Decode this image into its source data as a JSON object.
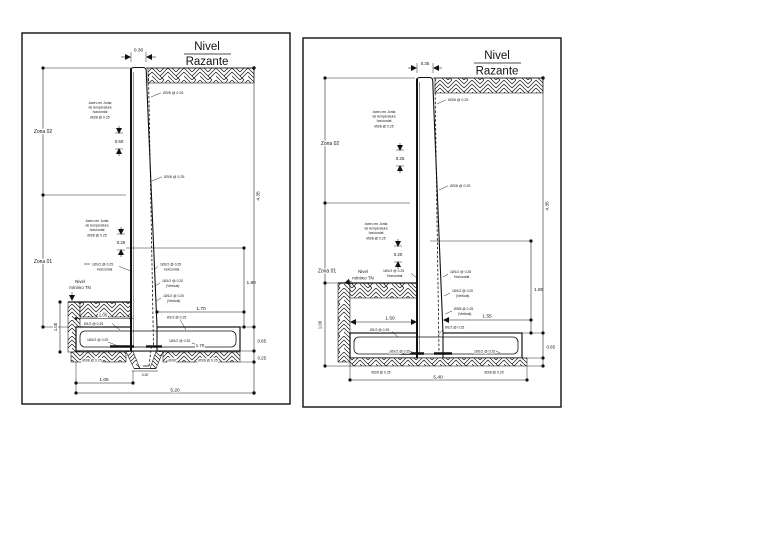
{
  "page": {
    "background": "#ffffff",
    "ink": "#111111"
  },
  "left_panel": {
    "title_top": "Nivel",
    "title_bottom": "Razante",
    "zona_02": "Zona 02",
    "zona_01": "Zona 01",
    "nivel_minimo_1": "Nivel",
    "nivel_minimo_2": "mínimo TN",
    "note_top": {
      "l1": "Acero en Junta",
      "l2": "de temperatura",
      "l3": "horizontal",
      "l4": "Ø3/8 @ 0.25"
    },
    "note_mid": {
      "l1": "Acero en Junta",
      "l2": "de temperatura",
      "l3": "horizontal",
      "l4": "Ø3/8 @ 0.25"
    },
    "dims": {
      "crown_width": "0.30",
      "upper_spacing": "0.50",
      "lower_spacing": "0.25",
      "wall_height": "4.35",
      "stem_lower": "1.80",
      "toe_length": "1.70",
      "footing_rebar": "1.70",
      "heel_top": "1.05",
      "excavation_depth": "1.00",
      "footing_thickness": "0.65",
      "subgrade_layer": "0.25",
      "heel_bottom": "1.05",
      "base_width": "5.20",
      "key_width": "0.30"
    },
    "callouts": {
      "stem_upper": "Ø3/8 @ 0.25",
      "stem_mid": "Ø3/8 @ 0.25",
      "left_horiz_1": "1Ø1/2 @ 0.25",
      "left_horiz_2": "Horizontal",
      "right_horiz_1": "1Ø1/2 @ 0.25",
      "right_horiz_2": "Horizontal",
      "right_vert1_1": "1Ø1/2 @ 0.20",
      "right_vert1_2": "(Vertical)",
      "right_vert2_1": "1Ø1/2 @ 0.20",
      "right_vert2_2": "(Vertical)",
      "heel_bar": "Ø1/2 @ 0.25",
      "toe_bar": "Ø1/2 @ 0.25",
      "footing_bar_left": "1Ø1/2 @ 0.25",
      "footing_bar_right": "1Ø1/2 @ 0.25",
      "bottom_left": "Ø3/8 @ 0.25",
      "bottom_mid": "Ø3/8",
      "bottom_right": "Ø3/8 @ 0.25"
    }
  },
  "right_panel": {
    "title_top": "Nivel",
    "title_bottom": "Razante",
    "zona_02": "Zona 02",
    "zona_01": "Zona 01",
    "nivel_minimo_1": "Nivel",
    "nivel_minimo_2": "mínimo TN",
    "note_top": {
      "l1": "Acero en Junta",
      "l2": "de temperatura",
      "l3": "horizontal",
      "l4": "Ø3/8 @ 0.25"
    },
    "note_mid": {
      "l1": "Acero en Junta",
      "l2": "de temperatura",
      "l3": "horizontal",
      "l4": "Ø3/8 @ 0.25"
    },
    "dims": {
      "crown_width": "0.35",
      "upper_spacing": "0.25",
      "lower_spacing": "0.20",
      "wall_height": "4.35",
      "stem_lower": "1.80",
      "heel_length": "1.50",
      "toe_length": "1.55",
      "excavation_depth": "1.00",
      "footing_thickness": "0.65",
      "base_width": "5.40"
    },
    "callouts": {
      "stem_upper": "Ø3/8 @ 0.25",
      "stem_mid": "Ø3/8 @ 0.25",
      "left_horiz_1": "1Ø1/2 @ 0.25",
      "left_horiz_2": "Horizontal",
      "right_horiz_1": "1Ø1/2 @ 0.25",
      "right_horiz_2": "Horizontal",
      "right_vert1_1": "1Ø1/2 @ 0.20",
      "right_vert1_2": "(Vertical)",
      "right_vert2_1": "Ø3/8 @ 0.25",
      "right_vert2_2": "(Vertical)",
      "heel_bar": "Ø1/2 @ 0.25",
      "toe_bar": "Ø1/2 @ 0.25",
      "footing_bar_left": "1Ø1/2 @ 0.25",
      "footing_bar_right": "1Ø1/2 @ 0.25",
      "bottom_left": "Ø3/8 @ 0.25",
      "bottom_right": "Ø3/8 @ 0.25"
    }
  }
}
